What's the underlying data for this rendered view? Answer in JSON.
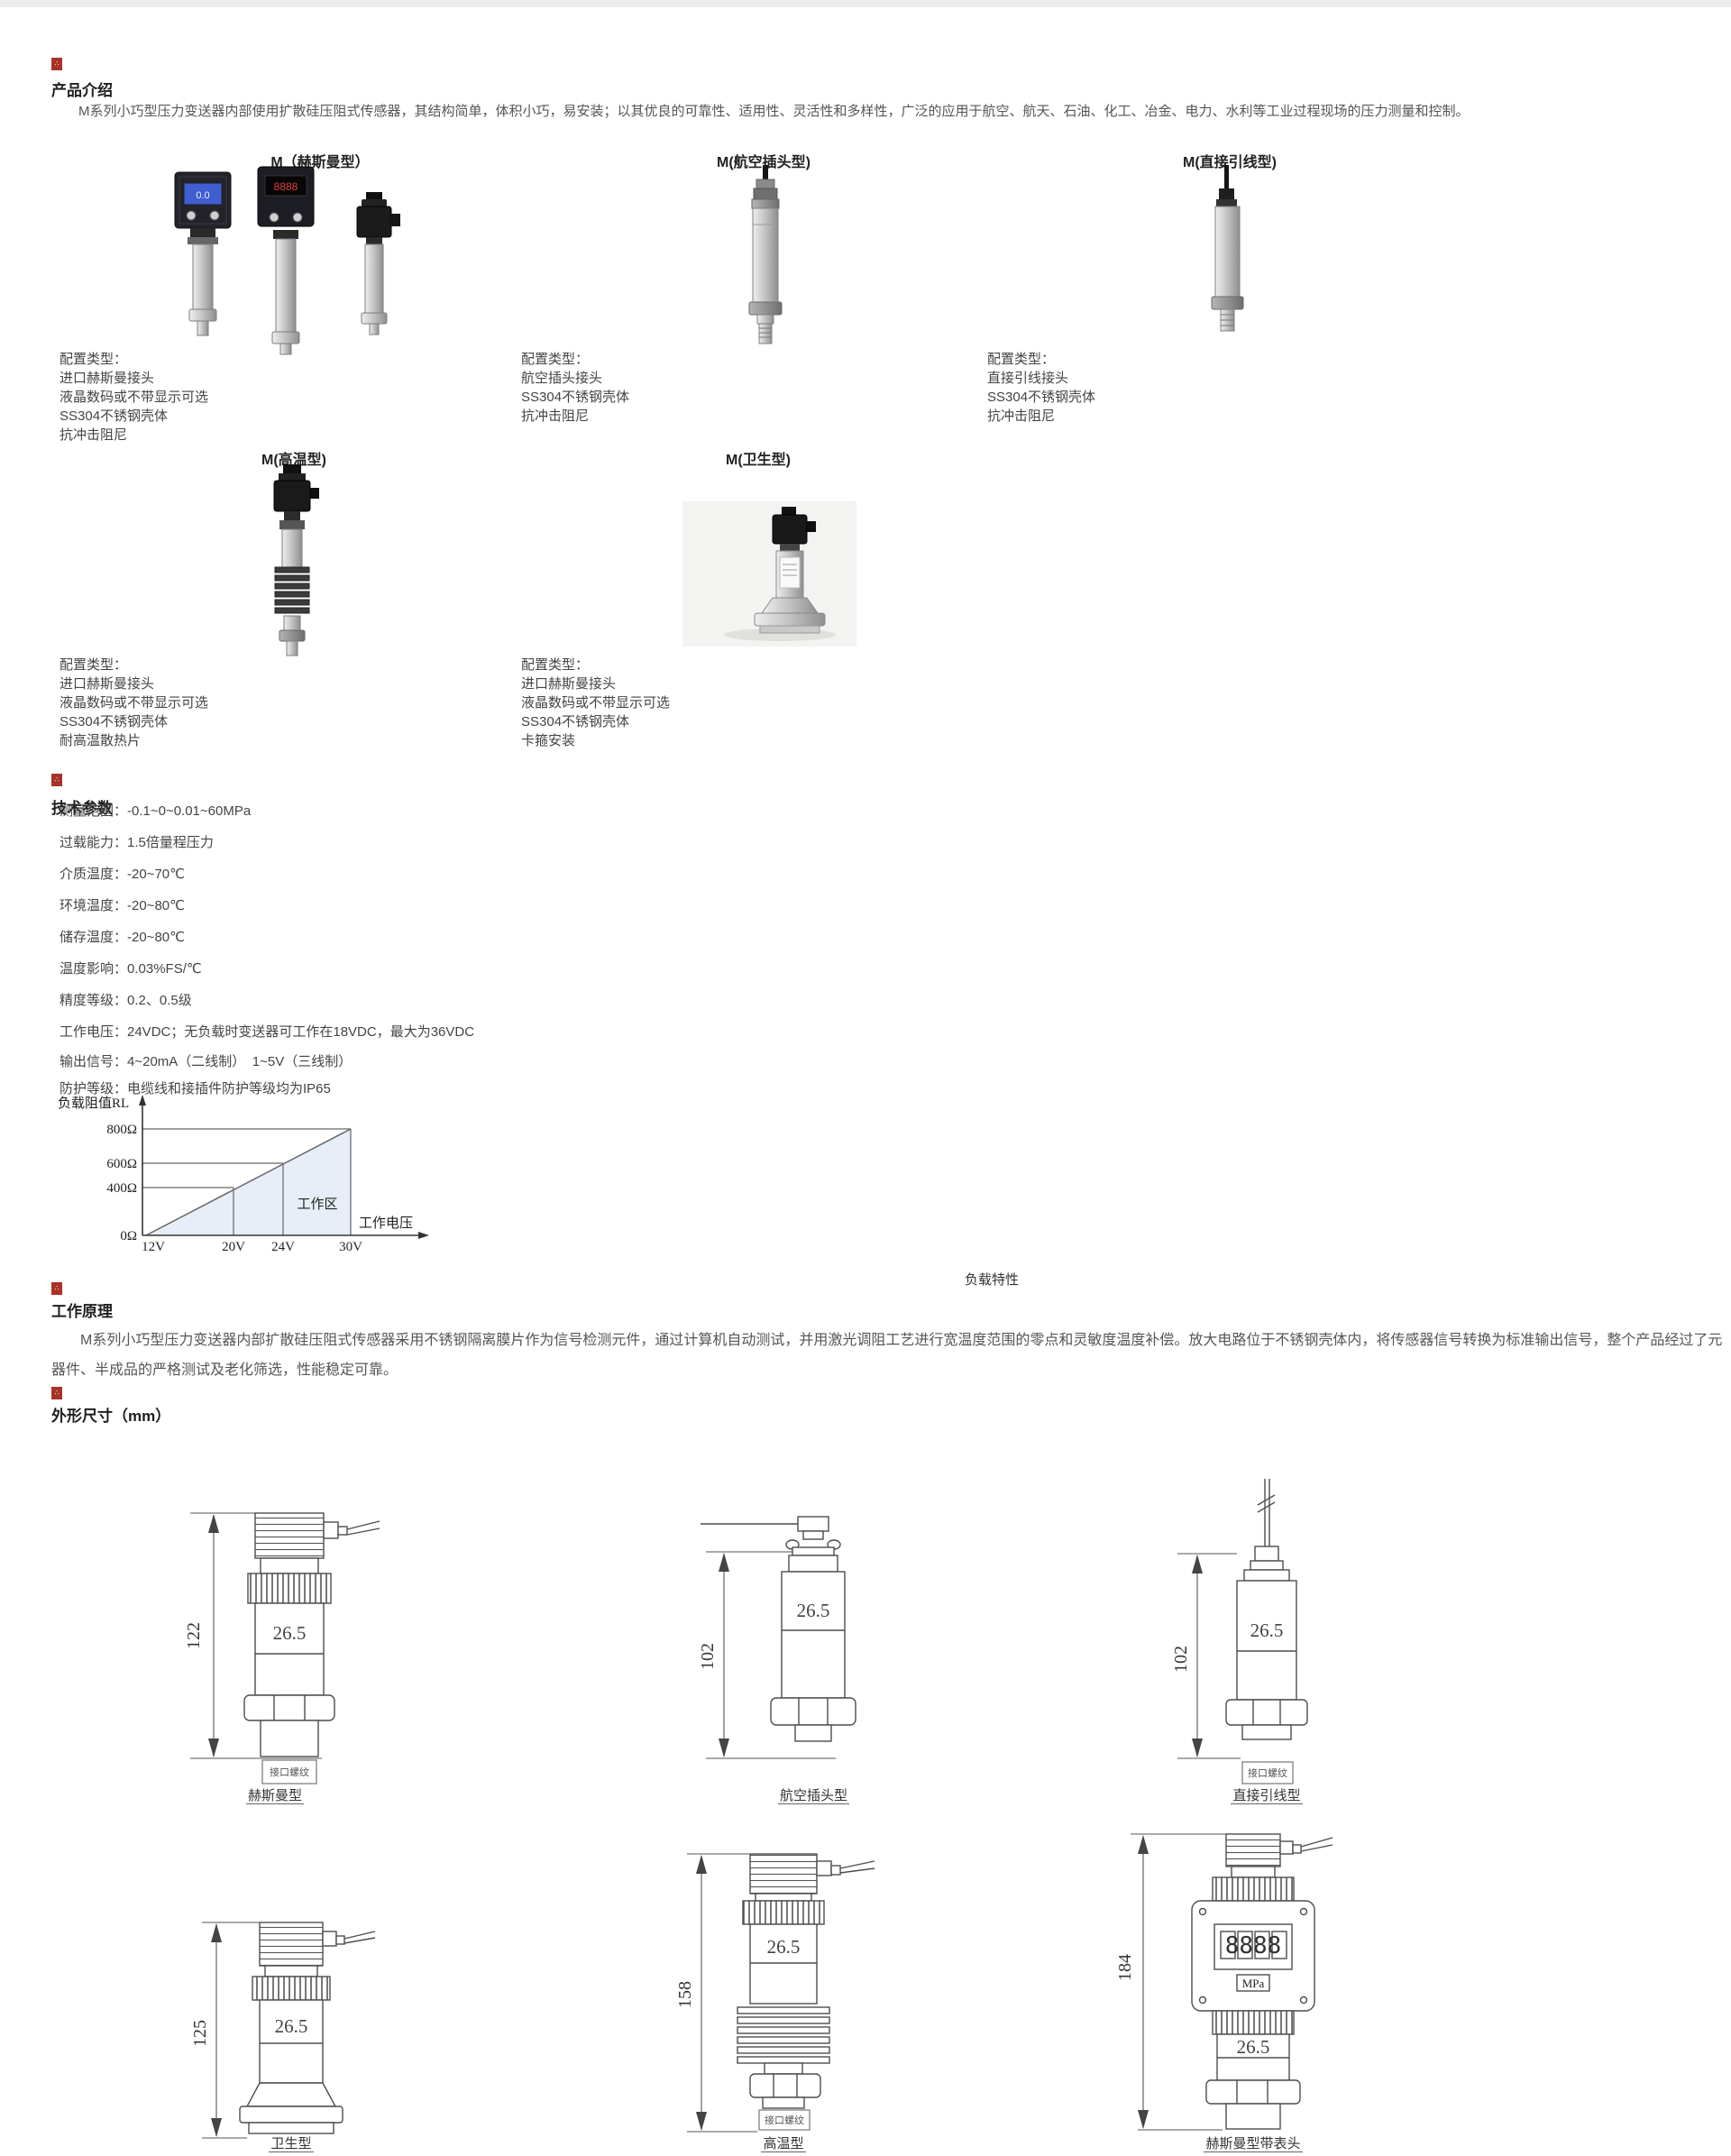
{
  "page": {
    "topbar_color": "#ececec"
  },
  "colors": {
    "accent_red": "#a93226",
    "chart_fill": "#e7eef7"
  },
  "intro": {
    "heading": "产品介绍",
    "body": "M系列小巧型压力变送器内部使用扩散硅压阻式传感器，其结构简单，体积小巧，易安装；以其优良的可靠性、适用性、灵活性和多样性，广泛的应用于航空、航天、石油、化工、冶金、电力、水利等工业过程现场的压力测量和控制。"
  },
  "products": [
    {
      "label": "M（赫斯曼型）",
      "lcd_value": "0.0",
      "led_value": "8888",
      "config": [
        "配置类型：",
        "进口赫斯曼接头",
        "液晶数码或不带显示可选",
        "SS304不锈钢壳体",
        "抗冲击阻尼"
      ]
    },
    {
      "label": "M(航空插头型)",
      "config": [
        "配置类型：",
        "航空插头接头",
        "SS304不锈钢壳体",
        "抗冲击阻尼"
      ]
    },
    {
      "label": "M(直接引线型)",
      "config": [
        "配置类型：",
        "直接引线接头",
        "SS304不锈钢壳体",
        "抗冲击阻尼"
      ]
    },
    {
      "label": "M(高温型)",
      "config": [
        "配置类型：",
        "进口赫斯曼接头",
        "液晶数码或不带显示可选",
        "SS304不锈钢壳体",
        "耐高温散热片"
      ]
    },
    {
      "label": "M(卫生型)",
      "config": [
        "配置类型：",
        "进口赫斯曼接头",
        "液晶数码或不带显示可选",
        "SS304不锈钢壳体",
        "卡箍安装"
      ]
    }
  ],
  "tech": {
    "heading": "技术参数",
    "params": [
      "测量范围：-0.1~0~0.01~60MPa",
      "过载能力：1.5倍量程压力",
      "介质温度：-20~70℃",
      "环境温度：-20~80℃",
      "储存温度：-20~80℃",
      "温度影响：0.03%FS/℃",
      "精度等级：0.2、0.5级",
      "工作电压：24VDC；无负载时变送器可工作在18VDC，最大为36VDC",
      "输出信号：4~20mA（二线制）　1~5V（三线制）",
      "防护等级：电缆线和接插件防护等级均为IP65"
    ]
  },
  "chart_data": {
    "type": "line",
    "title": "负载特性",
    "ylabel": "负载阻值RL",
    "xlabel": "工作电压",
    "x_ticks": [
      "12V",
      "20V",
      "24V",
      "30V"
    ],
    "y_ticks": [
      "0Ω",
      "400Ω",
      "600Ω",
      "800Ω"
    ],
    "points": [
      {
        "x": 12,
        "y": 0
      },
      {
        "x": 20,
        "y": 400
      },
      {
        "x": 24,
        "y": 600
      },
      {
        "x": 30,
        "y": 800
      }
    ],
    "region_label": "工作区",
    "x_range": [
      12,
      30
    ],
    "y_range": [
      0,
      800
    ],
    "grid": false,
    "legend": "none"
  },
  "principle": {
    "heading": "工作原理",
    "body": "M系列小巧型压力变送器内部扩散硅压阻式传感器采用不锈钢隔离膜片作为信号检测元件，通过计算机自动测试，并用激光调阻工艺进行宽温度范围的零点和灵敏度温度补偿。放大电路位于不锈钢壳体内，将传感器信号转换为标准输出信号，整个产品经过了元器件、半成品的严格测试及老化筛选，性能稳定可靠。"
  },
  "dims": {
    "heading": "外形尺寸（mm）",
    "drawings": [
      {
        "caption": "赫斯曼型",
        "dim": "122",
        "body_width": "26.5",
        "thread_label": "接口螺纹"
      },
      {
        "caption": "航空插头型",
        "dim": "102",
        "body_width": "26.5",
        "thread_label": ""
      },
      {
        "caption": "直接引线型",
        "dim": "102",
        "body_width": "26.5",
        "thread_label": "接口螺纹"
      },
      {
        "caption": "卫生型",
        "dim": "125",
        "body_width": "26.5",
        "thread_label": ""
      },
      {
        "caption": "高温型",
        "dim": "158",
        "body_width": "26.5",
        "thread_label": "接口螺纹"
      },
      {
        "caption": "赫斯曼型带表头",
        "dim": "184",
        "body_width": "26.5",
        "thread_label": "",
        "display_digits": "8888",
        "display_unit": "MPa"
      }
    ]
  }
}
